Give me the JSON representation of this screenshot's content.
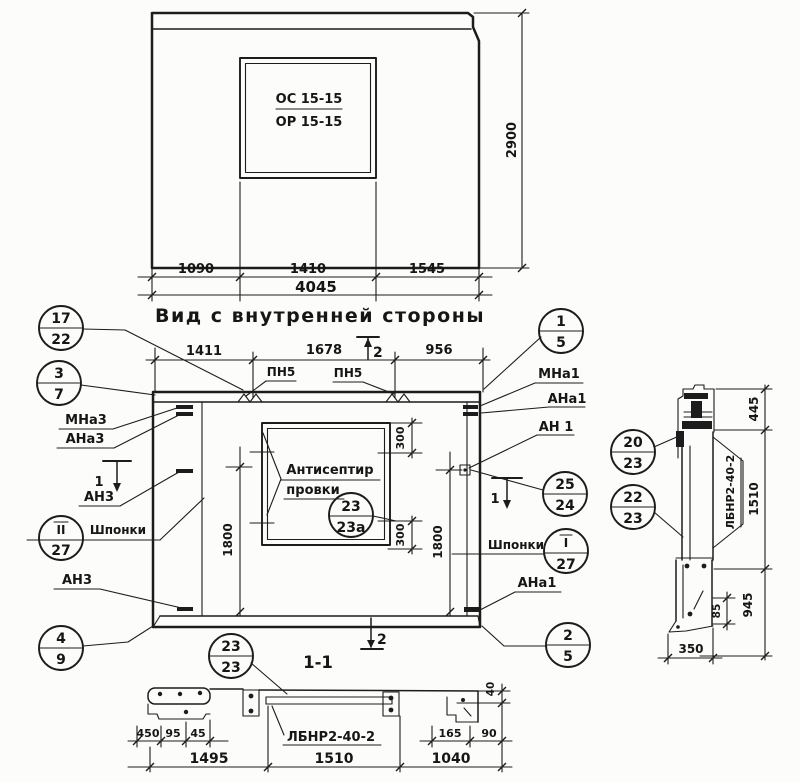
{
  "top_view": {
    "opening_mark_top": "ОС 15-15",
    "opening_mark_bottom": "ОР 15-15",
    "dim_1090": "1090",
    "dim_1410": "1410",
    "dim_1545": "1545",
    "dim_total": "4045",
    "dim_height": "2900"
  },
  "inner_view": {
    "title": "Вид с внутренней стороны",
    "dim_1411": "1411",
    "dim_1678": "1678",
    "dim_956": "956",
    "dim_1800_left": "1800",
    "dim_1800_right": "1800",
    "dim_300_top": "300",
    "dim_300_bottom": "300",
    "pn5_left": "ПН5",
    "pn5_right": "ПН5",
    "mna3": "МНа3",
    "ana3": "АНа3",
    "an3_upper": "АН3",
    "an3_lower": "АН3",
    "shponki_left": "Шпонки",
    "shponki_right": "Шпонки",
    "mna1": "МНа1",
    "ana1_upper": "АНа1",
    "an1": "АН 1",
    "ana1_lower": "АНа1",
    "note_line1": "Антисептир",
    "note_line2": "провки"
  },
  "section_markers": {
    "top": "2",
    "bottom": "2",
    "left": "1",
    "right": "1"
  },
  "callouts": {
    "c17_22": {
      "top": "17",
      "bottom": "22"
    },
    "c3_7": {
      "top": "3",
      "bottom": "7"
    },
    "c2r_27": {
      "top": "II",
      "bottom": "27"
    },
    "c4_9": {
      "top": "4",
      "bottom": "9"
    },
    "c1_5": {
      "top": "1",
      "bottom": "5"
    },
    "c25_24": {
      "top": "25",
      "bottom": "24"
    },
    "c1r_27": {
      "top": "I",
      "bottom": "27"
    },
    "c2_5": {
      "top": "2",
      "bottom": "5"
    },
    "c23_23a": {
      "top": "23",
      "bottom": "23а"
    },
    "c23_23": {
      "top": "23",
      "bottom": "23"
    },
    "c20_23": {
      "top": "20",
      "bottom": "23"
    },
    "c22_23": {
      "top": "22",
      "bottom": "23"
    }
  },
  "section_1_1": {
    "title": "1-1",
    "beam_label": "ЛБНР2-40-2",
    "dim_450": "450",
    "dim_95": "95",
    "dim_45": "45",
    "dim_1495": "1495",
    "dim_1510": "1510",
    "dim_1040": "1040",
    "dim_165": "165",
    "dim_90": "90",
    "dim_40": "40"
  },
  "side_section": {
    "beam_label": "ЛБНР2-40-2",
    "dim_445": "445",
    "dim_1510": "1510",
    "dim_945": "945",
    "dim_85": "85",
    "dim_350": "350"
  }
}
